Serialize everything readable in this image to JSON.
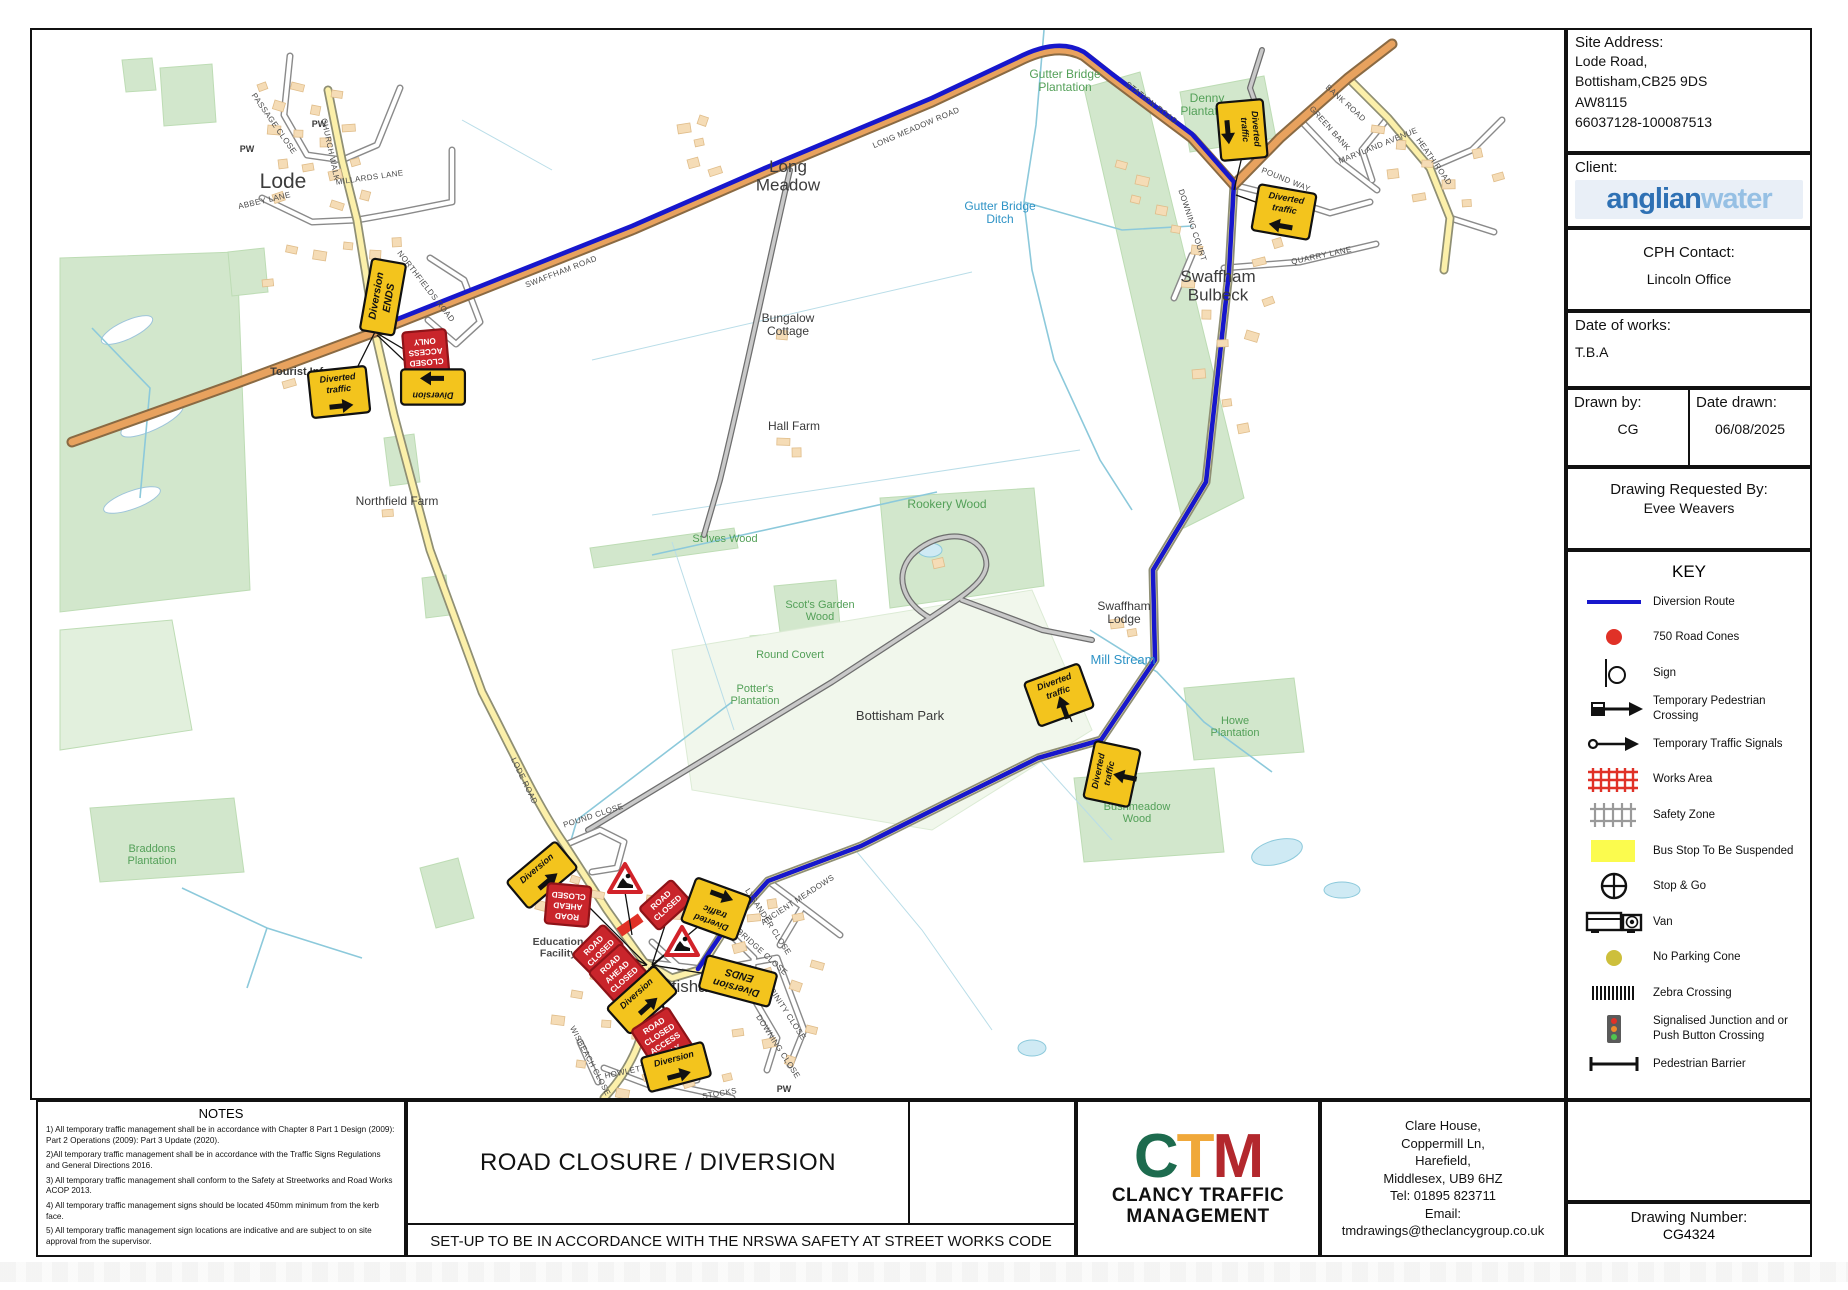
{
  "panel": {
    "site_address_label": "Site Address:",
    "site_address_lines": [
      "Lode Road,",
      "Bottisham,CB25 9DS",
      "AW8115",
      "66037128-100087513"
    ],
    "client_label": "Client:",
    "client_logo_part1": "anglian",
    "client_logo_part2": "water",
    "cph_label": "CPH Contact:",
    "cph_value": "Lincoln Office",
    "date_works_label": "Date of works:",
    "date_works_value": "T.B.A",
    "drawn_by_label": "Drawn by:",
    "drawn_by_value": "CG",
    "date_drawn_label": "Date drawn:",
    "date_drawn_value": "06/08/2025",
    "requested_label": "Drawing Requested By:",
    "requested_value": "Evee Weavers",
    "drawing_number_label": "Drawing Number:",
    "drawing_number_value": "CG4324"
  },
  "key": {
    "title": "KEY",
    "items": [
      {
        "icon": "diversion-route",
        "label": "Diversion Route"
      },
      {
        "icon": "road-cones",
        "label": "750 Road Cones"
      },
      {
        "icon": "sign",
        "label": "Sign"
      },
      {
        "icon": "temp-ped-crossing",
        "label": "Temporary Pedestrian Crossing"
      },
      {
        "icon": "temp-traffic-signals",
        "label": "Temporary Traffic Signals"
      },
      {
        "icon": "works-area",
        "label": "Works Area"
      },
      {
        "icon": "safety-zone",
        "label": "Safety Zone"
      },
      {
        "icon": "bus-stop",
        "label": "Bus Stop To Be Suspended"
      },
      {
        "icon": "stop-go",
        "label": "Stop & Go"
      },
      {
        "icon": "van",
        "label": "Van"
      },
      {
        "icon": "no-parking-cone",
        "label": "No Parking Cone"
      },
      {
        "icon": "zebra-crossing",
        "label": "Zebra Crossing"
      },
      {
        "icon": "signalised-junction",
        "label": "Signalised Junction and or Push Button Crossing"
      },
      {
        "icon": "pedestrian-barrier",
        "label": "Pedestrian Barrier"
      }
    ]
  },
  "notes": {
    "title": "NOTES",
    "items": [
      "1) All temporary traffic management shall be in accordance with Chapter 8 Part 1 Design (2009): Part 2 Operations (2009): Part 3 Update (2020).",
      "2)All temporary traffic management shall be in accordance with the Traffic Signs Regulations and General Directions 2016.",
      "3) All temporary traffic management shall conform to the Safety at Streetworks and Road Works ACOP 2013.",
      "4) All temporary traffic management signs should be located 450mm minimum from the kerb face.",
      "5) All temporary traffic management sign locations are indicative and are subject to on site approval from the supervisor."
    ]
  },
  "footer": {
    "drawing_title": "ROAD CLOSURE / DIVERSION",
    "compliance": "SET-UP TO BE IN ACCORDANCE WITH THE NRSWA SAFETY AT STREET WORKS CODE",
    "company": {
      "letter_c": "C",
      "letter_t": "T",
      "letter_m": "M",
      "name_line1": "CLANCY TRAFFIC",
      "name_line2": "MANAGEMENT",
      "address_lines": [
        "Clare House,",
        "Coppermill Ln,",
        "Harefield,",
        "Middlesex, UB9 6HZ",
        "Tel: 01895 823711",
        "Email:",
        "tmdrawings@theclancygroup.co.uk"
      ]
    }
  },
  "colors": {
    "diversion_route": "#1717cc",
    "road_cones": "#e03127",
    "works_area": "#e03127",
    "safety_zone": "#9a9a9a",
    "bus_stop": "#fbfb4e",
    "no_parking_cone": "#cdbf3c",
    "sign_yellow": "#f3c41d",
    "sign_red": "#c9252b",
    "ctm_green": "#1d6b4e",
    "ctm_amber": "#f0a83a",
    "ctm_red": "#b3282d",
    "anglian_blue_dark": "#2f71b4",
    "anglian_blue_light": "#96c0e4"
  },
  "map": {
    "labels": [
      {
        "text": "Lode",
        "x": 251,
        "y": 158,
        "size": 21,
        "color": "#3c3c3c"
      },
      {
        "lines": [
          "Long",
          "Meadow"
        ],
        "x": 756,
        "y": 142,
        "size": 17,
        "color": "#3c3c3c"
      },
      {
        "lines": [
          "Swaffham",
          "Bulbeck"
        ],
        "x": 1186,
        "y": 252,
        "size": 17,
        "color": "#3c3c3c"
      },
      {
        "text": "Bottisham",
        "x": 652,
        "y": 962,
        "size": 17,
        "color": "#3c3c3c"
      },
      {
        "lines": [
          "Bungalow",
          "Cottage"
        ],
        "x": 756,
        "y": 292,
        "size": 12
      },
      {
        "text": "Hall Farm",
        "x": 762,
        "y": 400,
        "size": 12
      },
      {
        "text": "Northfield Farm",
        "x": 365,
        "y": 475,
        "size": 12
      },
      {
        "lines": [
          "Swaffham",
          "Lodge"
        ],
        "x": 1092,
        "y": 580,
        "size": 12
      },
      {
        "text": "Bottisham Park",
        "x": 868,
        "y": 690,
        "size": 13
      },
      {
        "text": "Tourist Info",
        "x": 268,
        "y": 345,
        "size": 11,
        "bold": 1
      },
      {
        "lines": [
          "Education",
          "Facility"
        ],
        "x": 526,
        "y": 915,
        "size": 10.5,
        "bold": 1,
        "color": "#4a4a4a"
      },
      {
        "text": "PW",
        "x": 215,
        "y": 122,
        "size": 9,
        "bold": 1
      },
      {
        "text": "PW",
        "x": 287,
        "y": 97,
        "size": 9,
        "bold": 1
      },
      {
        "text": "PW",
        "x": 752,
        "y": 1062,
        "size": 9,
        "bold": 1
      },
      {
        "lines": [
          "Gutter Bridge",
          "Plantation"
        ],
        "x": 1033,
        "y": 48,
        "size": 12,
        "color": "#53a058"
      },
      {
        "lines": [
          "Denny",
          "Plantation"
        ],
        "x": 1175,
        "y": 72,
        "size": 12,
        "color": "#53a058"
      },
      {
        "text": "Rookery Wood",
        "x": 915,
        "y": 478,
        "size": 12,
        "color": "#53a058"
      },
      {
        "text": "St Ives Wood",
        "x": 693,
        "y": 512,
        "size": 11,
        "color": "#53a058"
      },
      {
        "lines": [
          "Scot's Garden",
          "Wood"
        ],
        "x": 788,
        "y": 578,
        "size": 11,
        "color": "#53a058"
      },
      {
        "text": "Round Covert",
        "x": 758,
        "y": 628,
        "size": 11,
        "color": "#53a058"
      },
      {
        "lines": [
          "Potter's",
          "Plantation"
        ],
        "x": 723,
        "y": 662,
        "size": 11,
        "color": "#53a058"
      },
      {
        "lines": [
          "Howe",
          "Plantation"
        ],
        "x": 1203,
        "y": 694,
        "size": 11,
        "color": "#53a058"
      },
      {
        "lines": [
          "Bushmeadow",
          "Wood"
        ],
        "x": 1105,
        "y": 780,
        "size": 11,
        "color": "#53a058"
      },
      {
        "lines": [
          "Braddons",
          "Plantation"
        ],
        "x": 120,
        "y": 822,
        "size": 11,
        "color": "#53a058"
      },
      {
        "lines": [
          "Gutter Bridge",
          "Ditch"
        ],
        "x": 968,
        "y": 180,
        "size": 12,
        "color": "#2e93c6"
      },
      {
        "text": "Mill Stream",
        "x": 1091,
        "y": 634,
        "size": 13,
        "color": "#2e93c6"
      }
    ],
    "road_names": [
      {
        "text": "SWAFFHAM ROAD",
        "x": 530,
        "y": 244,
        "rot": -21
      },
      {
        "text": "LONG MEADOW ROAD",
        "x": 885,
        "y": 100,
        "rot": -23
      },
      {
        "text": "STATION ROAD",
        "x": 1118,
        "y": 75,
        "rot": 38
      },
      {
        "text": "NORTHFIELDS ROAD",
        "x": 392,
        "y": 258,
        "rot": 52
      },
      {
        "text": "MILLARDS LANE",
        "x": 338,
        "y": 150,
        "rot": -8
      },
      {
        "text": "ABBEY LANE",
        "x": 233,
        "y": 173,
        "rot": -13
      },
      {
        "text": "PASSAGE CLOSE",
        "x": 240,
        "y": 95,
        "rot": 55
      },
      {
        "text": "CHURCH WALK",
        "x": 296,
        "y": 120,
        "rot": 78
      },
      {
        "text": "LODE ROAD",
        "x": 490,
        "y": 752,
        "rot": 64
      },
      {
        "text": "POUND CLOSE",
        "x": 562,
        "y": 788,
        "rot": -18
      },
      {
        "text": "HOWLETT WAY",
        "x": 604,
        "y": 1042,
        "rot": -12
      },
      {
        "text": "WISBEACH CLOSE",
        "x": 556,
        "y": 1032,
        "rot": 62
      },
      {
        "text": "STOCKS",
        "x": 688,
        "y": 1066,
        "rot": -10
      },
      {
        "text": "DOWNING COURT",
        "x": 1158,
        "y": 196,
        "rot": 72
      },
      {
        "text": "POUND WAY",
        "x": 1253,
        "y": 152,
        "rot": 22
      },
      {
        "text": "QUARRY LANE",
        "x": 1290,
        "y": 228,
        "rot": -12
      },
      {
        "text": "GREEN BANK",
        "x": 1296,
        "y": 100,
        "rot": 48
      },
      {
        "text": "HEATH ROAD",
        "x": 1400,
        "y": 133,
        "rot": 55
      },
      {
        "text": "MARYLAND AVENUE",
        "x": 1347,
        "y": 118,
        "rot": -22
      },
      {
        "text": "BANK ROAD",
        "x": 1312,
        "y": 75,
        "rot": 42
      },
      {
        "text": "ANCIENT MEADOWS",
        "x": 767,
        "y": 872,
        "rot": -33
      },
      {
        "text": "LYSANDER CLOSE",
        "x": 734,
        "y": 893,
        "rot": 57
      },
      {
        "text": "TUNBRIDGE CLOSE",
        "x": 722,
        "y": 918,
        "rot": 42
      },
      {
        "text": "TRINITY CLOSE",
        "x": 752,
        "y": 983,
        "rot": 57
      },
      {
        "text": "DOWNING CLOSE",
        "x": 744,
        "y": 1018,
        "rot": 57
      }
    ],
    "signs": [
      {
        "t": "y",
        "lines": [
          "Diversion",
          "ENDS"
        ],
        "x": 351,
        "y": 267,
        "rot": -80,
        "big": 1
      },
      {
        "t": "r",
        "lines": [
          "ROAD",
          "CLOSED",
          "ACCESS",
          "ONLY"
        ],
        "x": 394,
        "y": 326,
        "rot": 175
      },
      {
        "t": "y",
        "lines": [
          "Diversion"
        ],
        "arrow": "right",
        "x": 401,
        "y": 357,
        "rot": 180
      },
      {
        "t": "y",
        "lines": [
          "Diverted",
          "traffic"
        ],
        "arrow": "right",
        "x": 307,
        "y": 362,
        "rot": -6
      },
      {
        "t": "y",
        "lines": [
          "Diverted",
          "traffic"
        ],
        "arrow": "right",
        "x": 1210,
        "y": 100,
        "rot": 85
      },
      {
        "t": "y",
        "lines": [
          "Diverted",
          "traffic"
        ],
        "arrow": "left",
        "x": 1252,
        "y": 182,
        "rot": 10
      },
      {
        "t": "y",
        "lines": [
          "Diverted",
          "traffic"
        ],
        "arrow": "up",
        "x": 1027,
        "y": 665,
        "rot": -20
      },
      {
        "t": "y",
        "lines": [
          "Diverted",
          "traffic"
        ],
        "arrow": "up",
        "x": 1080,
        "y": 744,
        "rot": -78
      },
      {
        "t": "y",
        "lines": [
          "Diversion"
        ],
        "arrow": "right",
        "x": 510,
        "y": 845,
        "rot": -40
      },
      {
        "t": "r",
        "lines": [
          "ROAD",
          "AHEAD",
          "CLOSED"
        ],
        "x": 536,
        "y": 875,
        "rot": 185
      },
      {
        "t": "r",
        "lines": [
          "ROAD",
          "CLOSED"
        ],
        "x": 633,
        "y": 875,
        "rot": -42
      },
      {
        "t": "y",
        "lines": [
          "Diverted",
          "traffic"
        ],
        "arrow": "left",
        "x": 684,
        "y": 879,
        "rot": 200
      },
      {
        "t": "tri",
        "x": 593,
        "y": 850
      },
      {
        "t": "tri",
        "x": 650,
        "y": 913
      },
      {
        "t": "r",
        "lines": [
          "ROAD",
          "CLOSED"
        ],
        "x": 566,
        "y": 920,
        "rot": -45
      },
      {
        "t": "r",
        "lines": [
          "ROAD",
          "AHEAD",
          "CLOSED"
        ],
        "x": 586,
        "y": 943,
        "rot": -42
      },
      {
        "t": "y",
        "lines": [
          "Diversion"
        ],
        "arrow": "right",
        "x": 610,
        "y": 970,
        "rot": -42
      },
      {
        "t": "y",
        "lines": [
          "Diversion",
          "ENDS"
        ],
        "x": 706,
        "y": 951,
        "rot": 195,
        "big": 1
      },
      {
        "t": "r",
        "lines": [
          "ROAD",
          "CLOSED",
          "ACCESS",
          "ONLY"
        ],
        "x": 631,
        "y": 1010,
        "rot": -33
      },
      {
        "t": "y",
        "lines": [
          "Diversion"
        ],
        "arrow": "right",
        "x": 644,
        "y": 1037,
        "rot": -15
      }
    ]
  }
}
